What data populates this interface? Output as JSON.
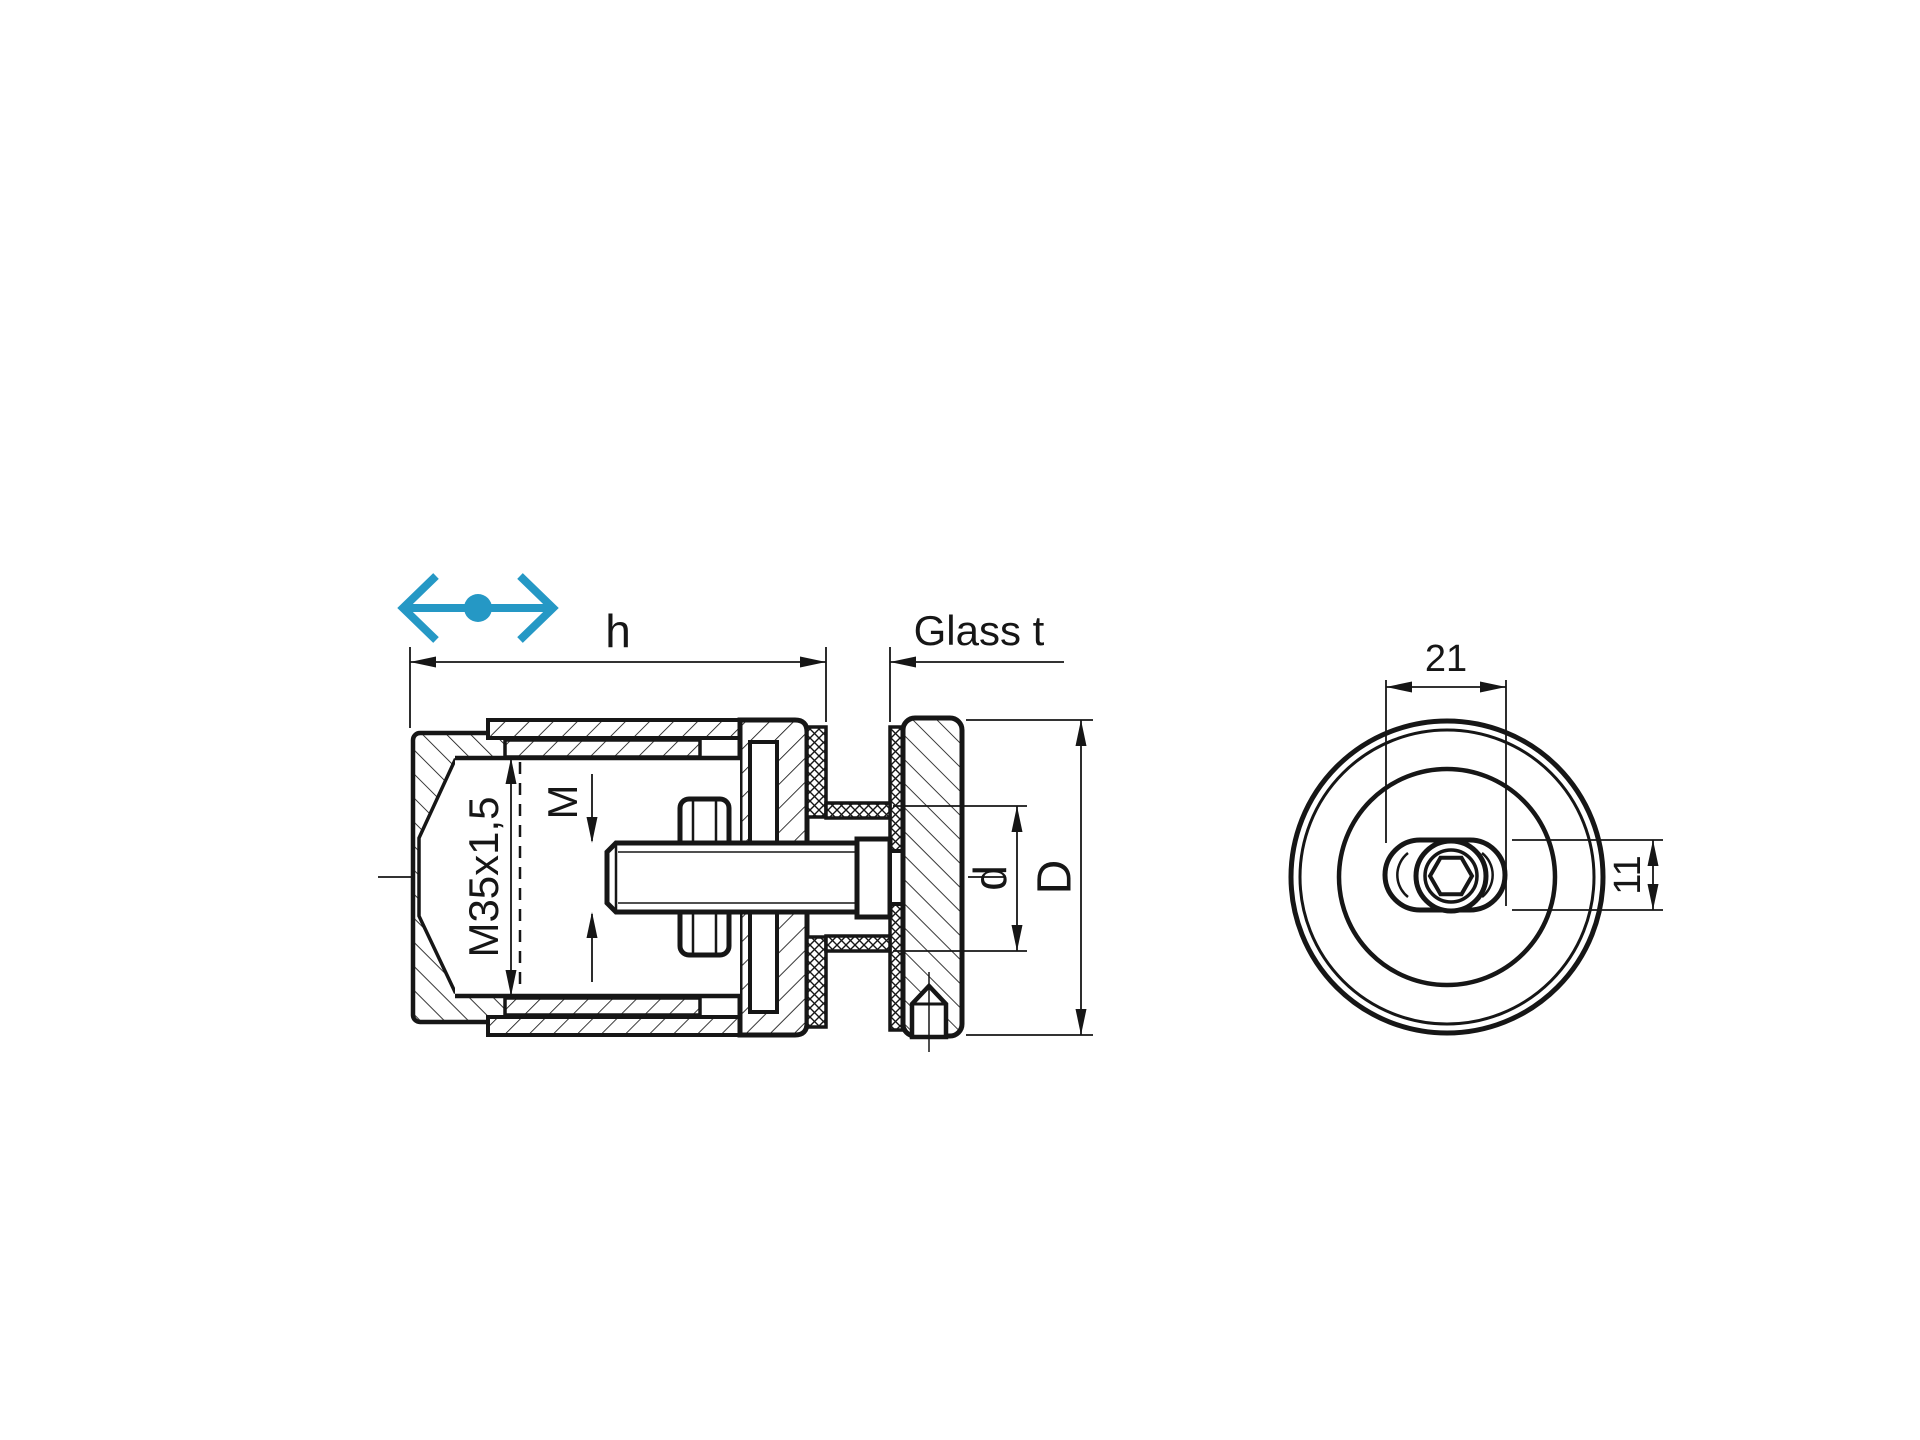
{
  "title": "Glass point holder technical drawing",
  "accent_color": "#2598c5",
  "ink_color": "#161616",
  "icons": {
    "move": "horizontal-move-arrow"
  },
  "section_view": {
    "h": "h",
    "glass_t": "Glass t",
    "thread": "M35x1,5",
    "bolt_m": "M",
    "hole_d": "d",
    "outer_D": "D"
  },
  "front_view": {
    "slot_width": "21",
    "slot_height": "11"
  }
}
